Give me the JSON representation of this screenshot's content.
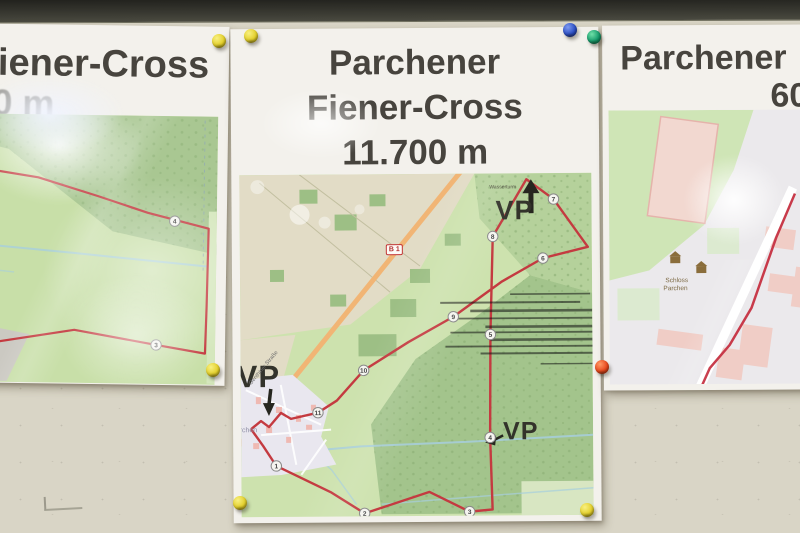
{
  "posters": {
    "left": {
      "title_line1": "Fiener-Cross",
      "title_line2": "0 m",
      "route_markers": [
        {
          "n": "4",
          "x": 222,
          "y": 105
        },
        {
          "n": "3",
          "x": 205,
          "y": 229
        }
      ]
    },
    "center": {
      "title_line1": "Parchener",
      "title_line2": "Fiener-Cross",
      "title_line3": "11.700 m",
      "map": {
        "vp_top": "VP",
        "vp_left": "VP",
        "vp_right": "VP",
        "road_shield": "B 1",
        "street_label": "Genthiner Straße",
        "town_label": "Parchen",
        "poi_label": "Wasserturm",
        "route_markers": [
          {
            "n": "1",
            "x": 35,
            "y": 291
          },
          {
            "n": "2",
            "x": 123,
            "y": 339
          },
          {
            "n": "3",
            "x": 228,
            "y": 338
          },
          {
            "n": "4",
            "x": 249,
            "y": 264
          },
          {
            "n": "5",
            "x": 250,
            "y": 161
          },
          {
            "n": "6",
            "x": 303,
            "y": 85
          },
          {
            "n": "7",
            "x": 314,
            "y": 26
          },
          {
            "n": "8",
            "x": 253,
            "y": 63
          },
          {
            "n": "9",
            "x": 213,
            "y": 143
          },
          {
            "n": "10",
            "x": 123,
            "y": 196
          },
          {
            "n": "11",
            "x": 77,
            "y": 238
          }
        ]
      }
    },
    "right": {
      "title_line1": "Parchener",
      "title_line2": "60",
      "poi_label_line1": "Schloss",
      "poi_label_line2": "Parchen"
    }
  },
  "pins": [
    {
      "color": "yellow",
      "x": 219,
      "y": 41
    },
    {
      "color": "yellow",
      "x": 251,
      "y": 36
    },
    {
      "color": "blue",
      "x": 570,
      "y": 30
    },
    {
      "color": "green",
      "x": 594,
      "y": 37
    },
    {
      "color": "yellow",
      "x": 213,
      "y": 370
    },
    {
      "color": "red",
      "x": 602,
      "y": 367
    },
    {
      "color": "yellow",
      "x": 240,
      "y": 503
    },
    {
      "color": "yellow",
      "x": 587,
      "y": 510
    }
  ],
  "pin_palette": {
    "yellow": {
      "light": "#f8f082",
      "base": "#e3cf2a",
      "dark": "#8a7a10"
    },
    "blue": {
      "light": "#7f9bf0",
      "base": "#2c4fc4",
      "dark": "#14246e"
    },
    "green": {
      "light": "#6fe0a8",
      "base": "#15996a",
      "dark": "#065a3a"
    },
    "red": {
      "light": "#ff9a66",
      "base": "#e8481c",
      "dark": "#8a2408"
    }
  },
  "colors": {
    "route_red": "#c43a40",
    "road_orange": "#f1b575",
    "forest_green": "#a3c48c",
    "field_green": "#cde2ae",
    "field_beige": "#e2dcc6",
    "stream_blue": "#a7cedd",
    "title_text": "#47443e"
  }
}
